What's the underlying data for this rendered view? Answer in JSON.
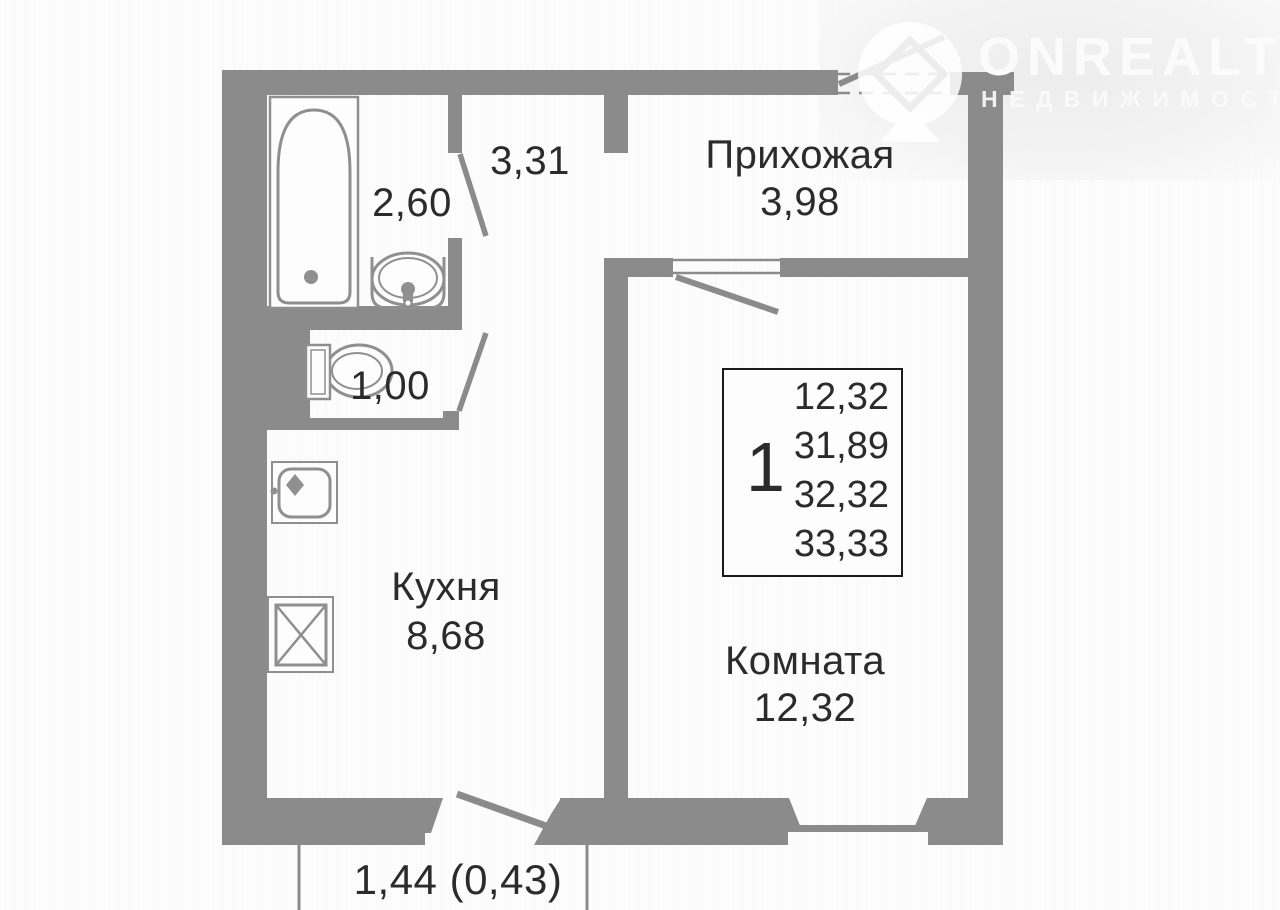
{
  "colors": {
    "wall": "#8b8b8b",
    "fixture": "#8f8f8f",
    "text": "#2b2b2b",
    "legend_border": "#1b1b1b",
    "logo": "#fbfbfb",
    "background": "#fcfcfc"
  },
  "branding": {
    "name": "ONREALT",
    "tagline": "НЕДВИЖИМОСТЬ"
  },
  "plan": {
    "rooms": {
      "hallway": {
        "name": "Прихожая",
        "area": "3,98"
      },
      "corridor": {
        "area": "3,31"
      },
      "bathroom": {
        "area": "2,60"
      },
      "wc": {
        "area": "1,00"
      },
      "kitchen": {
        "name": "Кухня",
        "area": "8,68"
      },
      "living_room": {
        "name": "Комната",
        "area": "12,32"
      },
      "balcony": {
        "area": "1,44 (0,43)"
      }
    },
    "legend": {
      "rooms_count": "1",
      "areas": [
        "12,32",
        "31,89",
        "32,32",
        "33,33"
      ]
    }
  }
}
